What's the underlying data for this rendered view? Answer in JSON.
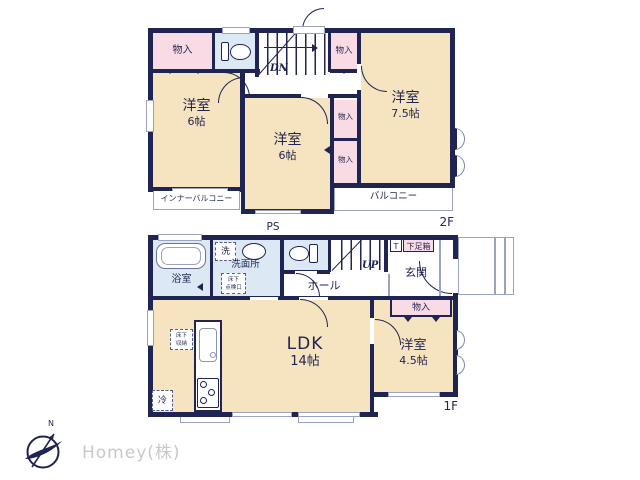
{
  "colors": {
    "wall": "#1f2452",
    "room_fill": "#f6e3bf",
    "closet_fill": "#f8dbe4",
    "wet_area_fill": "#dce9f5",
    "thin_line": "#9aa3c0",
    "logo_text": "#c8c8c8"
  },
  "floor2": {
    "label": "2F",
    "stairs": "DN",
    "closet_top_left": "物入",
    "closet_top_right": "物入",
    "closet_mid_upper": "物入",
    "closet_mid_lower": "物入",
    "room_left_name": "洋室",
    "room_left_size": "6帖",
    "room_center_name": "洋室",
    "room_center_size": "6帖",
    "room_right_name": "洋室",
    "room_right_size": "7.5帖",
    "inner_balcony": "インナーバルコニー",
    "balcony": "バルコニー"
  },
  "floor1": {
    "label": "1F",
    "stairs": "UP",
    "ps": "PS",
    "bathroom": "浴室",
    "washer": "洗",
    "washroom": "洗面所",
    "hatch_line1": "床下",
    "hatch_line2": "点検口",
    "hall": "ホール",
    "toilet_tag": "T",
    "shoe_box": "下足箱",
    "entrance": "玄関",
    "closet": "物入",
    "ldk_name": "LDK",
    "ldk_size": "14帖",
    "room_right_name": "洋室",
    "room_right_size": "4.5帖",
    "storage_line1": "床下",
    "storage_line2": "収納",
    "fridge": "冷"
  },
  "logo": {
    "company": "Homey(株)",
    "north": "N"
  }
}
